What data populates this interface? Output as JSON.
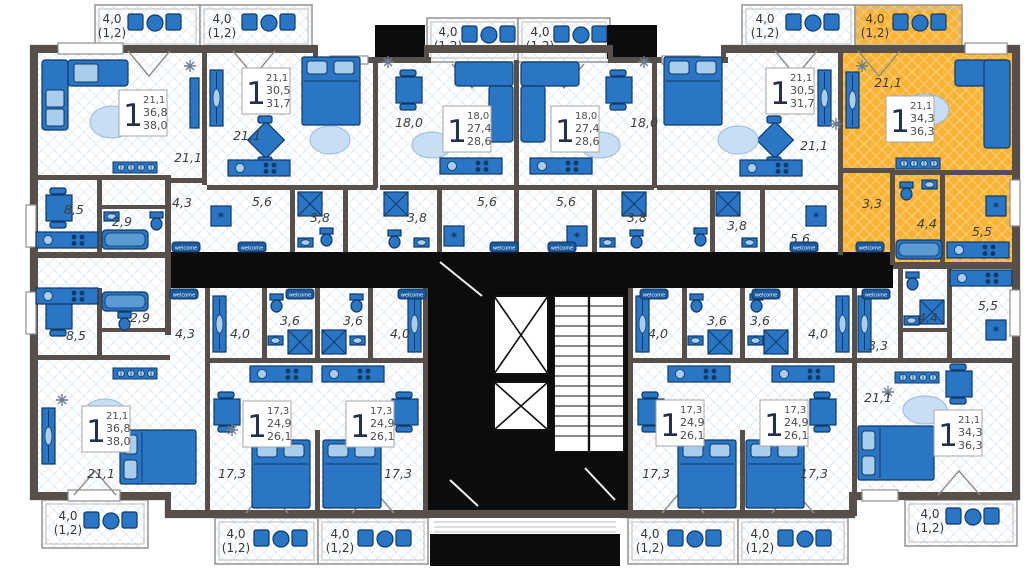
{
  "plan": {
    "highlight_color": "#f9b233",
    "furniture_color": "#2a75c4",
    "wall_color": "#57504a",
    "corridor_color": "#0c0c0c",
    "welcome_mat": "welcome",
    "washer_symbol": "*",
    "balcony": {
      "area": "4,0",
      "coef": "(1,2)"
    },
    "units": {
      "u1": {
        "rooms": "1",
        "living": "21,1",
        "total": "36,8",
        "total_b": "38,0",
        "labels": {
          "living": "21,1",
          "kitchen": "8,5",
          "bath": "2,9",
          "hall": "4,3"
        }
      },
      "u2": {
        "rooms": "1",
        "living": "21,1",
        "total": "30,5",
        "total_b": "31,7",
        "labels": {
          "living": "21,1",
          "hall": "5,6",
          "bath": "3,8"
        }
      },
      "u3": {
        "rooms": "1",
        "living": "18,0",
        "total": "27,4",
        "total_b": "28,6",
        "labels": {
          "living": "18,0",
          "hall": "5,6",
          "bath": "3,8"
        }
      },
      "u4": {
        "rooms": "1",
        "living": "18,0",
        "total": "27,4",
        "total_b": "28,6",
        "labels": {
          "living": "18,0",
          "hall": "5,6",
          "bath": "3,8"
        }
      },
      "u5": {
        "rooms": "1",
        "living": "21,1",
        "total": "30,5",
        "total_b": "31,7",
        "labels": {
          "living": "21,1",
          "hall": "5,6",
          "bath": "3,8"
        }
      },
      "u6": {
        "rooms": "1",
        "living": "21,1",
        "total": "34,3",
        "total_b": "36,3",
        "highlighted": true,
        "labels": {
          "living": "21,1",
          "hall": "3,3",
          "bath": "4,4",
          "kitchen": "5,5"
        }
      },
      "u7": {
        "rooms": "1",
        "living": "21,1",
        "total": "36,8",
        "total_b": "38,0",
        "labels": {
          "living": "21,1",
          "kitchen": "8,5",
          "bath": "2,9",
          "hall": "4,3"
        }
      },
      "u8": {
        "rooms": "1",
        "living": "17,3",
        "total": "24,9",
        "total_b": "26,1",
        "labels": {
          "living": "17,3",
          "hall": "4,0",
          "bath": "3,6"
        }
      },
      "u9": {
        "rooms": "1",
        "living": "17,3",
        "total": "24,9",
        "total_b": "26,1",
        "labels": {
          "living": "17,3",
          "hall": "4,0",
          "bath": "3,6"
        }
      },
      "u10": {
        "rooms": "1",
        "living": "17,3",
        "total": "24,9",
        "total_b": "26,1",
        "labels": {
          "living": "17,3",
          "hall": "4,0",
          "bath": "3,6"
        }
      },
      "u11": {
        "rooms": "1",
        "living": "17,3",
        "total": "24,9",
        "total_b": "26,1",
        "labels": {
          "living": "17,3",
          "hall": "4,0",
          "bath": "3,6"
        }
      },
      "u12": {
        "rooms": "1",
        "living": "21,1",
        "total": "34,3",
        "total_b": "36,3",
        "labels": {
          "living": "21,1",
          "hall": "3,3",
          "bath": "4,4",
          "kitchen": "5,5"
        }
      }
    }
  }
}
